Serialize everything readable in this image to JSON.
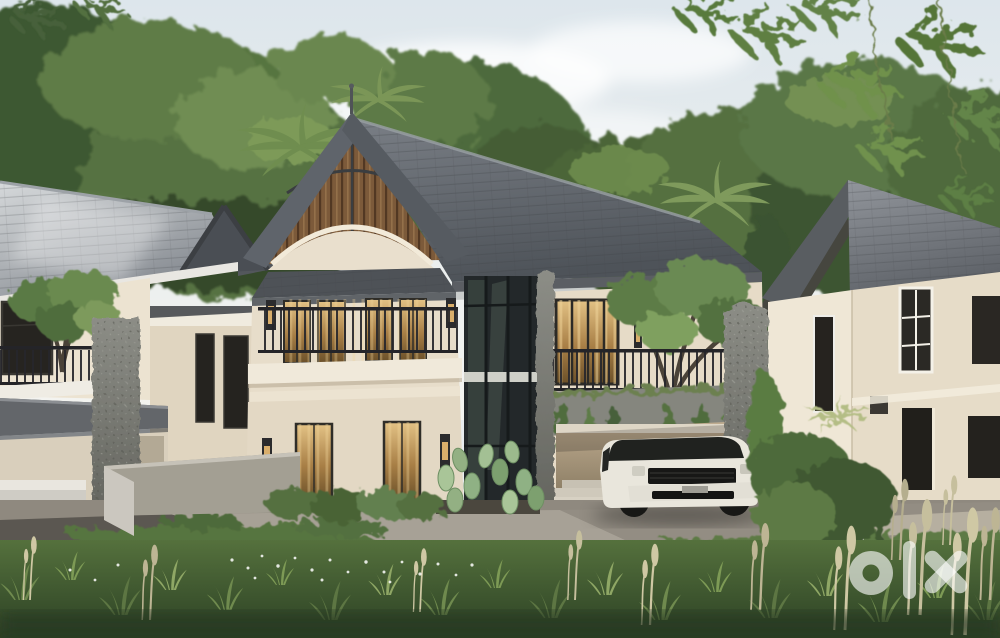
{
  "watermark": {
    "brand": "olx",
    "color": "#ffffff",
    "opacity": 0.62
  },
  "palette": {
    "sky_top": "#dde6ec",
    "sky_horizon": "#f4f4f0",
    "foliage_dark": "#3c5531",
    "foliage_mid": "#57743f",
    "foliage_light": "#7d9a58",
    "roof_main_dark": "#4e5359",
    "gable_fascia": "#5f646b",
    "wood_slats": "#7c5a3a",
    "wall_cream": "#e7ddca",
    "wall_shade": "#e3d8c4",
    "wall_right_wing": "#e6dbc7",
    "white_trim": "#f0e9da",
    "stone": "#7e7f78",
    "glass": "#23282a",
    "warm_light": "#c9a263",
    "railing": "#26262b",
    "asphalt": "#5b5751",
    "concrete": "#a7a196",
    "driveway": "#938d83",
    "grass_dark": "#2c4124",
    "grass_mid": "#55713d",
    "grass_light": "#8fa765",
    "grass_dry": "#cfc8a4",
    "car_body": "#e9e6dc",
    "car_glass": "#20221f"
  }
}
